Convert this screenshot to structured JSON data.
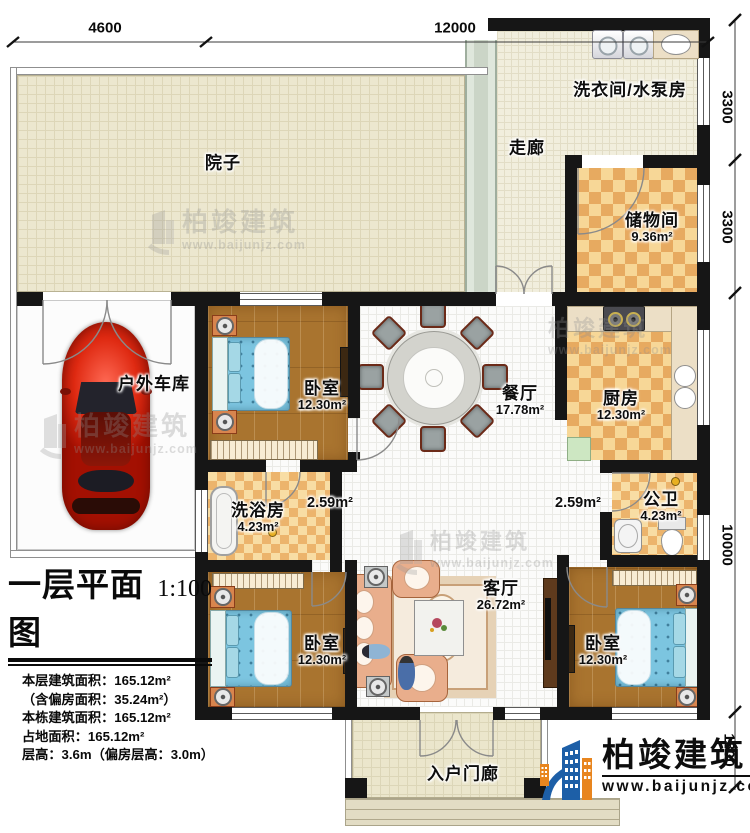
{
  "dimensions": {
    "top": [
      {
        "label": "4600"
      },
      {
        "label": "12000"
      }
    ],
    "right": [
      {
        "label": "3300"
      },
      {
        "label": "3300"
      },
      {
        "label": "10000"
      },
      {
        "label": "1800"
      }
    ]
  },
  "rooms": {
    "yard": {
      "name": "院子"
    },
    "corridor": {
      "name": "走廊"
    },
    "laundry": {
      "name": "洗衣间/水泵房"
    },
    "storage": {
      "name": "储物间",
      "area": "9.36m²"
    },
    "bedroom_top": {
      "name": "卧室",
      "area": "12.30m²"
    },
    "dining": {
      "name": "餐厅",
      "area": "17.78m²"
    },
    "kitchen": {
      "name": "厨房",
      "area": "12.30m²"
    },
    "garage": {
      "name": "户外车库"
    },
    "bath": {
      "name": "洗浴房",
      "area": "4.23m²"
    },
    "hall_left": {
      "area": "2.59m²"
    },
    "hall_right": {
      "area": "2.59m²"
    },
    "wc": {
      "name": "公卫",
      "area": "4.23m²"
    },
    "living": {
      "name": "客厅",
      "area": "26.72m²"
    },
    "bedroom_bl": {
      "name": "卧室",
      "area": "12.30m²"
    },
    "bedroom_br": {
      "name": "卧室",
      "area": "12.30m²"
    },
    "porch": {
      "name": "入户门廊"
    }
  },
  "title_block": {
    "title": "一层平面图",
    "scale": "1:100",
    "stats": [
      "本层建筑面积：165.12m²",
      "（含偏房面积：35.24m²）",
      "本栋建筑面积：165.12m²",
      "占地面积：165.12m²",
      "层高：3.6m（偏房层高：3.0m）"
    ]
  },
  "branding": {
    "company": "柏竣建筑",
    "website": "www.baijunjz.com"
  },
  "watermark": {
    "company": "柏竣建筑",
    "website": "www.baijunjz.com"
  },
  "colors": {
    "wall": "#161616",
    "checker_light": "#f7d797",
    "checker_dark": "#e7aa60",
    "wood_floor": "#a9742f",
    "bed_blue": "#7cc5e0",
    "brand_blue": "#1d5fa7",
    "brand_orange": "#e8851e"
  }
}
